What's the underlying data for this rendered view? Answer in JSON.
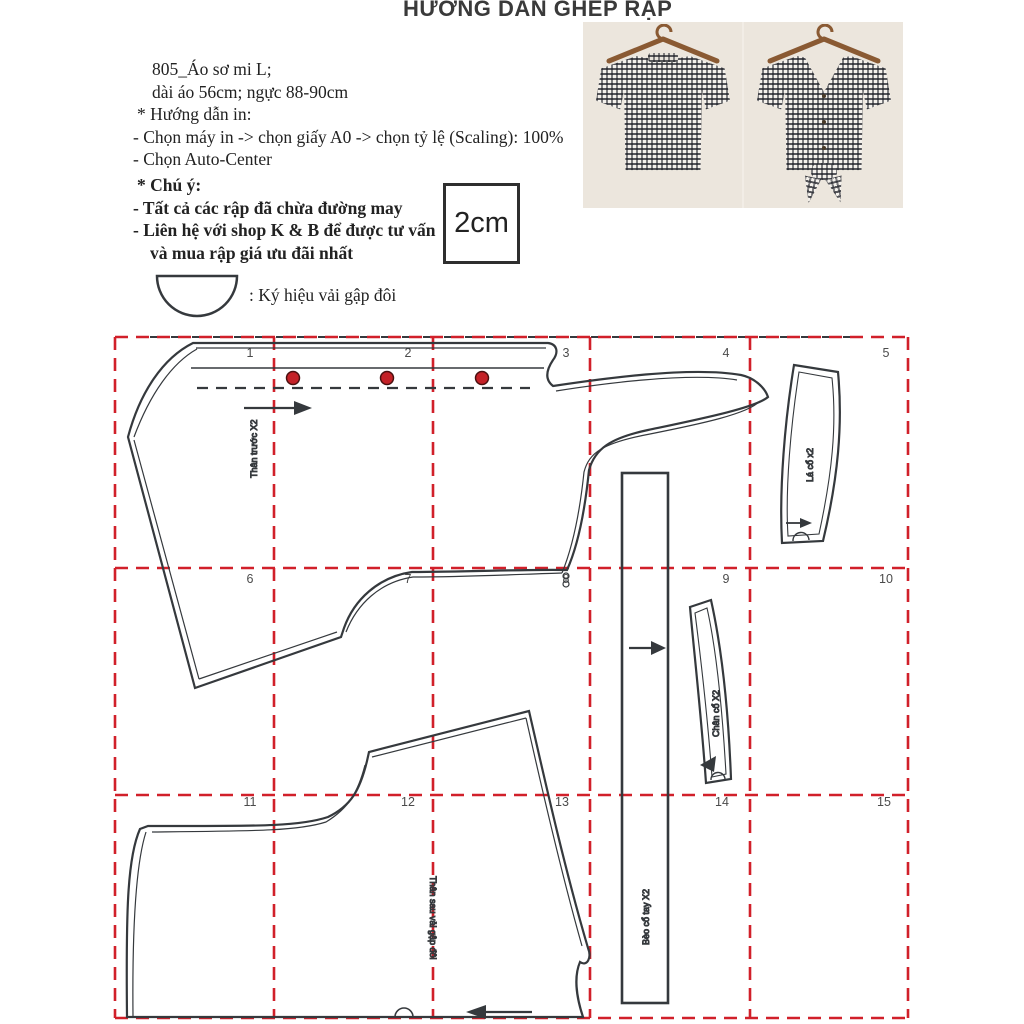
{
  "title": "HƯỚNG DẪN GHÉP RẬP",
  "info": {
    "line1": "805_Áo sơ mi L;",
    "line2": "dài áo 56cm; ngực 88-90cm",
    "print_heading": "* Hướng dẫn in:",
    "print_step1": "- Chọn máy in -> chọn giấy A0  -> chọn tỷ lệ (Scaling): 100%",
    "print_step2": "- Chọn Auto-Center"
  },
  "notes": {
    "heading": "* Chú ý:",
    "note1": "- Tất cả các rập đã chừa đường may",
    "note2": "- Liên hệ với  shop K & B để được tư vấn",
    "note3": "và mua rập giá ưu đãi nhất"
  },
  "scale_box_label": "2cm",
  "fold_legend": ": Ký hiệu vải gập đôi",
  "grid": {
    "cells": [
      "1",
      "2",
      "3",
      "4",
      "5",
      "6",
      "7",
      "8",
      "9",
      "10",
      "11",
      "12",
      "13",
      "14",
      "15"
    ]
  },
  "pieces": [
    {
      "label": "Thân trước X2"
    },
    {
      "label": "Lá cổ x2"
    },
    {
      "label": "Bèo cổ tay X2"
    },
    {
      "label": "Chân cổ X2"
    },
    {
      "label": "Thân sau vải gập đôi"
    }
  ],
  "colors": {
    "grid_red": "#d1202a",
    "line_dark": "#35393d",
    "button_red": "#c42127",
    "photo_background": "#ece6dd"
  }
}
